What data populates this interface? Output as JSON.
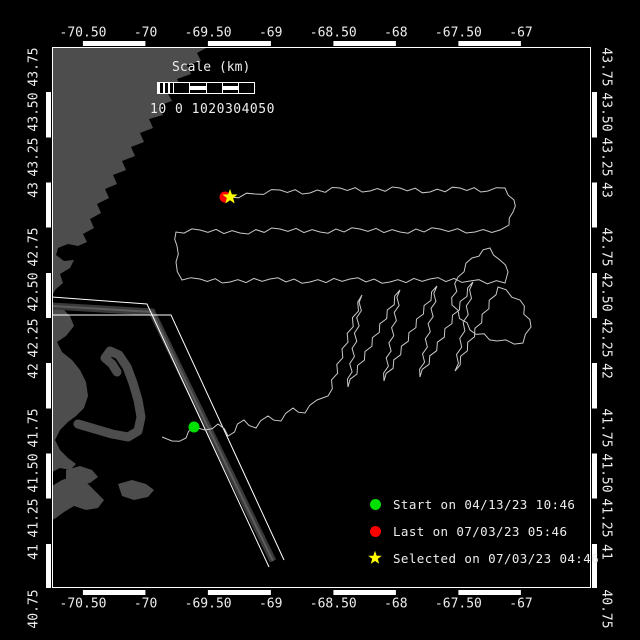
{
  "colors": {
    "background": "#000000",
    "land": "#4d4d4d",
    "track": "#c9c9c9",
    "frame": "#ffffff",
    "text": "#ededed",
    "start": "#00e000",
    "last": "#ff0000",
    "selected": "#ffff00",
    "lane_band": "#3a3a3a",
    "lane_core": "#5c5c5c"
  },
  "axes": {
    "lon_labels": [
      "-70.50",
      "-70",
      "-69.50",
      "-69",
      "-68.50",
      "-68",
      "-67.50",
      "-67"
    ],
    "lat_labels": [
      "43.75",
      "43.50",
      "43.25",
      "43",
      "42.75",
      "42.50",
      "42.25",
      "42",
      "41.75",
      "41.50",
      "41.25",
      "41",
      "40.75"
    ],
    "lon_tick_start_x": 83,
    "lon_tick_step_x": 62.57,
    "lat_tick_start_y": 47,
    "lat_tick_step_y": 45.17,
    "top_label_y": 33,
    "bottom_label_y": 604,
    "left_label_x": 34,
    "right_label_x": 606
  },
  "scalebar": {
    "title": "Scale (km)",
    "values": "10 0 1020304050",
    "cells": [
      "hatch",
      "plain",
      "stripe",
      "plain",
      "stripe",
      "plain"
    ]
  },
  "legend": {
    "items": [
      {
        "marker": "start-dot",
        "color": "#00e000",
        "label": "Start on 04/13/23 10:46"
      },
      {
        "marker": "last-dot",
        "color": "#ff0000",
        "label": "Last on 07/03/23 05:46"
      },
      {
        "marker": "selected-star",
        "color": "#ffff00",
        "label": "Selected on 07/03/23 04:46"
      }
    ],
    "row_spacing": 27
  },
  "markers": {
    "start": {
      "x": 194,
      "y": 427
    },
    "last": {
      "x": 225,
      "y": 197
    },
    "selected": {
      "x": 230,
      "y": 197
    }
  },
  "track": {
    "waypoints": [
      [
        162,
        437
      ],
      [
        172,
        441
      ],
      [
        186,
        438
      ],
      [
        194,
        427
      ],
      [
        205,
        430
      ],
      [
        218,
        424
      ],
      [
        228,
        436
      ],
      [
        244,
        420
      ],
      [
        256,
        428
      ],
      [
        268,
        416
      ],
      [
        281,
        421
      ],
      [
        293,
        408
      ],
      [
        305,
        413
      ],
      [
        317,
        400
      ],
      [
        328,
        396
      ],
      [
        362,
        295
      ],
      [
        348,
        387
      ],
      [
        400,
        290
      ],
      [
        384,
        381
      ],
      [
        437,
        286
      ],
      [
        420,
        377
      ],
      [
        473,
        282
      ],
      [
        455,
        371
      ],
      [
        498,
        287
      ],
      [
        520,
        300
      ],
      [
        531,
        327
      ],
      [
        523,
        343
      ],
      [
        497,
        341
      ],
      [
        470,
        330
      ],
      [
        452,
        305
      ],
      [
        458,
        277
      ],
      [
        472,
        258
      ],
      [
        490,
        248
      ],
      [
        500,
        260
      ],
      [
        508,
        272
      ],
      [
        505,
        283
      ],
      [
        470,
        281
      ],
      [
        430,
        279
      ],
      [
        390,
        282
      ],
      [
        350,
        279
      ],
      [
        310,
        282
      ],
      [
        270,
        279
      ],
      [
        230,
        282
      ],
      [
        200,
        279
      ],
      [
        182,
        280
      ],
      [
        176,
        262
      ],
      [
        177,
        246
      ],
      [
        176,
        232
      ],
      [
        200,
        230
      ],
      [
        240,
        233
      ],
      [
        280,
        229
      ],
      [
        320,
        232
      ],
      [
        360,
        229
      ],
      [
        400,
        232
      ],
      [
        440,
        229
      ],
      [
        475,
        232
      ],
      [
        500,
        230
      ],
      [
        509,
        225
      ],
      [
        513,
        212
      ],
      [
        514,
        200
      ],
      [
        505,
        188
      ],
      [
        488,
        191
      ],
      [
        460,
        188
      ],
      [
        430,
        192
      ],
      [
        400,
        188
      ],
      [
        370,
        191
      ],
      [
        340,
        188
      ],
      [
        310,
        193
      ],
      [
        280,
        190
      ],
      [
        255,
        194
      ],
      [
        230,
        197
      ]
    ],
    "wiggle_amplitude": 1.8,
    "wiggle_step": 8
  },
  "lane": {
    "edge_a": [
      [
        52,
        297
      ],
      [
        147,
        304
      ],
      [
        269,
        567
      ]
    ],
    "edge_b": [
      [
        52,
        315
      ],
      [
        171,
        315
      ],
      [
        284,
        560
      ]
    ],
    "band": [
      [
        52,
        306
      ],
      [
        152,
        312
      ],
      [
        273,
        561
      ]
    ]
  },
  "coast": {
    "polygons": [
      {
        "name": "maine-nh-coast",
        "points": [
          [
            52,
            47
          ],
          [
            208,
            47
          ],
          [
            197,
            53
          ],
          [
            201,
            61
          ],
          [
            187,
            65
          ],
          [
            191,
            74
          ],
          [
            177,
            79
          ],
          [
            182,
            88
          ],
          [
            167,
            92
          ],
          [
            172,
            101
          ],
          [
            158,
            106
          ],
          [
            163,
            115
          ],
          [
            149,
            119
          ],
          [
            153,
            128
          ],
          [
            140,
            133
          ],
          [
            144,
            142
          ],
          [
            131,
            147
          ],
          [
            135,
            156
          ],
          [
            122,
            161
          ],
          [
            126,
            170
          ],
          [
            113,
            175
          ],
          [
            117,
            184
          ],
          [
            105,
            189
          ],
          [
            109,
            198
          ],
          [
            97,
            204
          ],
          [
            101,
            213
          ],
          [
            90,
            219
          ],
          [
            94,
            228
          ],
          [
            83,
            234
          ],
          [
            87,
            242
          ],
          [
            78,
            246
          ],
          [
            68,
            244
          ],
          [
            58,
            248
          ],
          [
            56,
            255
          ],
          [
            64,
            261
          ],
          [
            74,
            260
          ],
          [
            70,
            268
          ],
          [
            60,
            274
          ],
          [
            63,
            283
          ],
          [
            55,
            290
          ],
          [
            52,
            296
          ]
        ]
      },
      {
        "name": "mass-bay-coast",
        "points": [
          [
            52,
            302
          ],
          [
            62,
            308
          ],
          [
            70,
            316
          ],
          [
            74,
            326
          ],
          [
            66,
            336
          ],
          [
            57,
            342
          ],
          [
            62,
            352
          ],
          [
            72,
            360
          ],
          [
            80,
            370
          ],
          [
            86,
            382
          ],
          [
            88,
            396
          ],
          [
            84,
            408
          ],
          [
            76,
            416
          ],
          [
            68,
            422
          ],
          [
            60,
            430
          ],
          [
            55,
            440
          ],
          [
            60,
            450
          ],
          [
            68,
            458
          ],
          [
            76,
            464
          ],
          [
            70,
            470
          ],
          [
            60,
            468
          ],
          [
            52,
            472
          ]
        ]
      },
      {
        "name": "buzzards-bay-mass",
        "points": [
          [
            52,
            486
          ],
          [
            62,
            480
          ],
          [
            74,
            476
          ],
          [
            86,
            482
          ],
          [
            96,
            492
          ],
          [
            104,
            500
          ],
          [
            98,
            508
          ],
          [
            86,
            510
          ],
          [
            74,
            506
          ],
          [
            64,
            512
          ],
          [
            56,
            518
          ],
          [
            52,
            520
          ]
        ]
      },
      {
        "name": "marthas-vineyard",
        "points": [
          [
            66,
            470
          ],
          [
            80,
            466
          ],
          [
            92,
            470
          ],
          [
            98,
            477
          ],
          [
            90,
            483
          ],
          [
            76,
            485
          ],
          [
            66,
            479
          ]
        ]
      },
      {
        "name": "nantucket",
        "points": [
          [
            118,
            484
          ],
          [
            132,
            480
          ],
          [
            146,
            484
          ],
          [
            154,
            490
          ],
          [
            148,
            497
          ],
          [
            134,
            500
          ],
          [
            122,
            496
          ]
        ]
      }
    ],
    "cape_cod_arm": [
      [
        78,
        424
      ],
      [
        95,
        429
      ],
      [
        112,
        434
      ],
      [
        128,
        437
      ],
      [
        138,
        431
      ],
      [
        141,
        417
      ],
      [
        138,
        400
      ],
      [
        133,
        383
      ],
      [
        127,
        367
      ],
      [
        119,
        355
      ],
      [
        110,
        351
      ],
      [
        105,
        358
      ],
      [
        112,
        364
      ],
      [
        117,
        372
      ]
    ]
  }
}
